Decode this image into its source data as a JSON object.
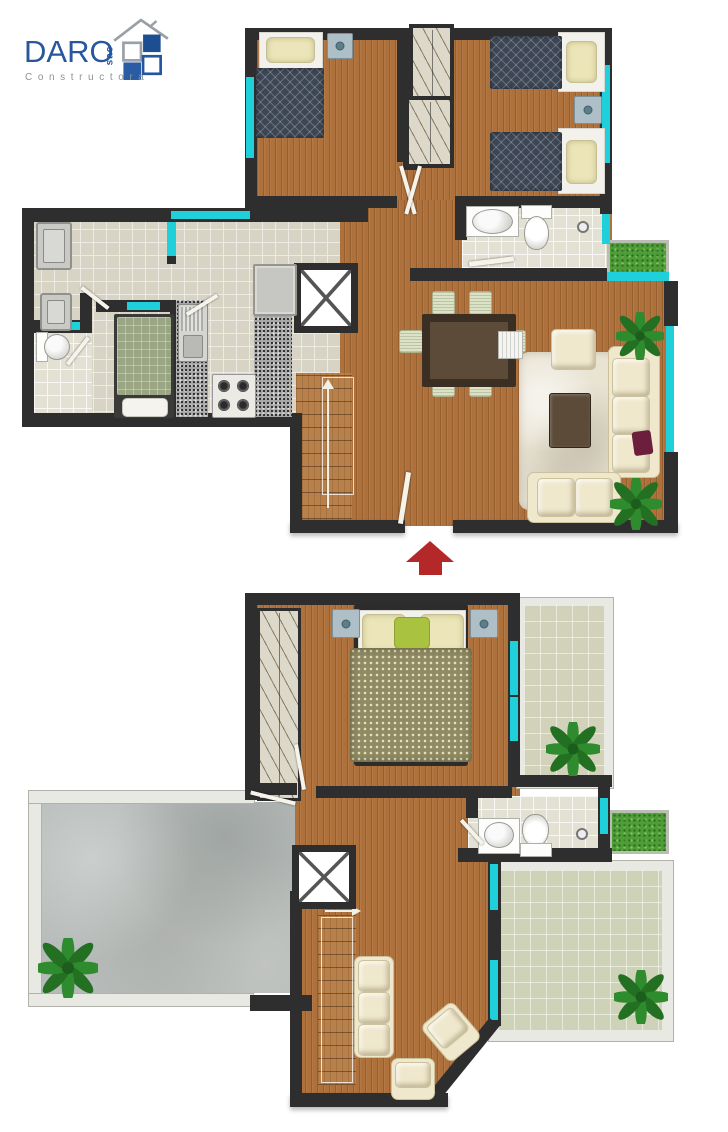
{
  "logo": {
    "brand": "DARO",
    "suffix": "sac",
    "subtitle": "Constructora"
  },
  "icons": {
    "between_floors": "up-arrow",
    "elevator": "x-cross",
    "upper_stairs_direction": "arrow-up",
    "lower_stairs_direction": "arrow-right",
    "plant": "plant"
  },
  "colors": {
    "brand_blue": "#27579E",
    "brand_blue_dark": "#1D4E92",
    "brand_gray": "#9AA0A6",
    "subtitle_gray": "#8D9296",
    "wall": "#2E2E2E",
    "window": "#1FD0DB",
    "wood": "#AE713C",
    "tile": "#D7D3C5",
    "grout": "#ECEAE2",
    "bath_tile": "#E3E0D4",
    "grass": "#4F9D38",
    "plant": "#2E8B2E",
    "concrete": "#B6BBB9",
    "parapet": "#E9E9E4",
    "terrace_tile": "#D2D2BA",
    "rug": "#E9E3D3",
    "cream": "#EFE8CD",
    "sofa_edge": "#CBC19D",
    "table_brown": "#5C4B39",
    "table_edge": "#3B2F23",
    "chair": "#DCE3C4",
    "navy": "#3C4654",
    "olive": "#8F8A64",
    "pillow_green": "#A9C23F",
    "pillow_maroon": "#6B1F3C",
    "pillow_cream": "#EBE5B9",
    "arrow_red": "#B5282A",
    "granite_base": "#A8A8A8",
    "appliance": "#C9C9C5",
    "closet": "#DCD8CA",
    "leaf_white": "#F6F3EA"
  }
}
